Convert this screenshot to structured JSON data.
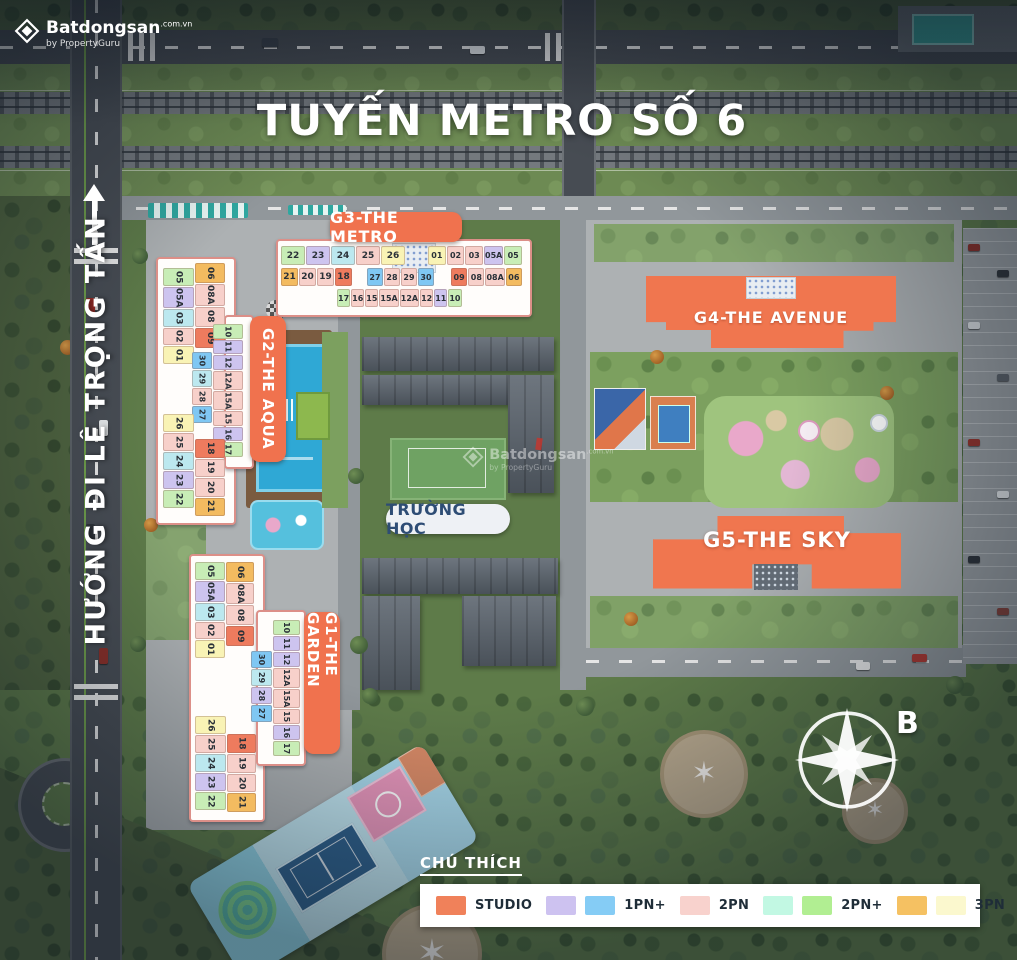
{
  "brand": {
    "name": "Batdongsan",
    "domain": ".com.vn",
    "byline": "by PropertyGuru"
  },
  "title": "TUYẾN METRO SỐ 6",
  "street_label": "HƯỚNG ĐI LÊ TRỌNG TẤN",
  "school_label": "TRƯỜNG HỌC",
  "compass_label": "B",
  "buildings": {
    "g3": {
      "name": "G3-THE METRO",
      "rows": {
        "r1l": [
          {
            "n": "22",
            "c": "#c8edb6"
          },
          {
            "n": "23",
            "c": "#cdc4ef"
          },
          {
            "n": "24",
            "c": "#bce8ef"
          },
          {
            "n": "25",
            "c": "#f7d0ca"
          },
          {
            "n": "26",
            "c": "#f9f3b5"
          }
        ],
        "r1r": [
          {
            "n": "01",
            "c": "#f9f3b5"
          },
          {
            "n": "02",
            "c": "#f7d0ca"
          },
          {
            "n": "03",
            "c": "#f7d0ca"
          },
          {
            "n": "05A",
            "c": "#cdc4ef"
          },
          {
            "n": "05",
            "c": "#c8edb6"
          }
        ],
        "r2l": [
          {
            "n": "21",
            "c": "#f3bb60"
          },
          {
            "n": "20",
            "c": "#f7d0ca"
          },
          {
            "n": "19",
            "c": "#f7d0ca"
          },
          {
            "n": "18",
            "c": "#ee7b5e"
          }
        ],
        "r2m": [
          {
            "n": "27",
            "c": "#7fc7f3"
          },
          {
            "n": "28",
            "c": "#f7d0ca"
          },
          {
            "n": "29",
            "c": "#f7d0ca"
          },
          {
            "n": "30",
            "c": "#7fc7f3"
          }
        ],
        "r2r": [
          {
            "n": "09",
            "c": "#ee7b5e"
          },
          {
            "n": "08",
            "c": "#f7d0ca"
          },
          {
            "n": "08A",
            "c": "#f7d0ca"
          },
          {
            "n": "06",
            "c": "#f3bb60"
          }
        ],
        "r3": [
          {
            "n": "17",
            "c": "#c8edb6"
          },
          {
            "n": "16",
            "c": "#f7d0ca"
          },
          {
            "n": "15",
            "c": "#f7d0ca"
          },
          {
            "n": "15A",
            "c": "#f7d0ca"
          },
          {
            "n": "12A",
            "c": "#f7d0ca"
          },
          {
            "n": "12",
            "c": "#f7d0ca"
          },
          {
            "n": "11",
            "c": "#cdc4ef"
          },
          {
            "n": "10",
            "c": "#c8edb6"
          }
        ]
      }
    },
    "g2": {
      "name": "G2-THE AQUA",
      "cols": {
        "a": [
          {
            "n": "05",
            "c": "#c8edb6"
          },
          {
            "n": "05A",
            "c": "#cdc4ef"
          },
          {
            "n": "03",
            "c": "#bce8ef"
          },
          {
            "n": "02",
            "c": "#f7d0ca"
          },
          {
            "n": "01",
            "c": "#f9f3b5"
          }
        ],
        "b": [
          {
            "n": "06",
            "c": "#f3bb60"
          },
          {
            "n": "08A",
            "c": "#f7d0ca"
          },
          {
            "n": "08",
            "c": "#f7d0ca"
          },
          {
            "n": "09",
            "c": "#ee7b5e"
          }
        ],
        "c": [
          {
            "n": "10",
            "c": "#c8edb6"
          },
          {
            "n": "11",
            "c": "#cdc4ef"
          },
          {
            "n": "12",
            "c": "#cdc4ef"
          },
          {
            "n": "12A",
            "c": "#f7d0ca"
          },
          {
            "n": "15A",
            "c": "#f7d0ca"
          },
          {
            "n": "15",
            "c": "#f7d0ca"
          },
          {
            "n": "16",
            "c": "#cdc4ef"
          },
          {
            "n": "17",
            "c": "#c8edb6"
          }
        ],
        "d": [
          {
            "n": "30",
            "c": "#7fc7f3"
          },
          {
            "n": "29",
            "c": "#bce8ef"
          },
          {
            "n": "28",
            "c": "#f7d0ca"
          },
          {
            "n": "27",
            "c": "#7fc7f3"
          }
        ],
        "e": [
          {
            "n": "26",
            "c": "#f9f3b5"
          },
          {
            "n": "25",
            "c": "#f7d0ca"
          },
          {
            "n": "24",
            "c": "#bce8ef"
          },
          {
            "n": "23",
            "c": "#cdc4ef"
          },
          {
            "n": "22",
            "c": "#c8edb6"
          }
        ],
        "f": [
          {
            "n": "18",
            "c": "#ee7b5e"
          },
          {
            "n": "19",
            "c": "#f7d0ca"
          },
          {
            "n": "20",
            "c": "#f7d0ca"
          },
          {
            "n": "21",
            "c": "#f3bb60"
          }
        ]
      }
    },
    "g1": {
      "name": "G1-THE GARDEN",
      "cols": {
        "a": [
          {
            "n": "05",
            "c": "#c8edb6"
          },
          {
            "n": "05A",
            "c": "#cdc4ef"
          },
          {
            "n": "03",
            "c": "#bce8ef"
          },
          {
            "n": "02",
            "c": "#f7d0ca"
          },
          {
            "n": "01",
            "c": "#f9f3b5"
          }
        ],
        "b": [
          {
            "n": "06",
            "c": "#f3bb60"
          },
          {
            "n": "08A",
            "c": "#f7d0ca"
          },
          {
            "n": "08",
            "c": "#f7d0ca"
          },
          {
            "n": "09",
            "c": "#ee7b5e"
          }
        ],
        "c": [
          {
            "n": "10",
            "c": "#c8edb6"
          },
          {
            "n": "11",
            "c": "#cdc4ef"
          },
          {
            "n": "12",
            "c": "#cdc4ef"
          },
          {
            "n": "12A",
            "c": "#f7d0ca"
          },
          {
            "n": "15A",
            "c": "#f7d0ca"
          },
          {
            "n": "15",
            "c": "#f7d0ca"
          },
          {
            "n": "16",
            "c": "#cdc4ef"
          },
          {
            "n": "17",
            "c": "#c8edb6"
          }
        ],
        "d": [
          {
            "n": "30",
            "c": "#7fc7f3"
          },
          {
            "n": "29",
            "c": "#bce8ef"
          },
          {
            "n": "28",
            "c": "#cdc4ef"
          },
          {
            "n": "27",
            "c": "#7fc7f3"
          }
        ],
        "e": [
          {
            "n": "26",
            "c": "#f9f3b5"
          },
          {
            "n": "25",
            "c": "#f7d0ca"
          },
          {
            "n": "24",
            "c": "#bce8ef"
          },
          {
            "n": "23",
            "c": "#cdc4ef"
          },
          {
            "n": "22",
            "c": "#c8edb6"
          }
        ],
        "f": [
          {
            "n": "18",
            "c": "#ee7b5e"
          },
          {
            "n": "19",
            "c": "#f7d0ca"
          },
          {
            "n": "20",
            "c": "#f7d0ca"
          },
          {
            "n": "21",
            "c": "#f3bb60"
          }
        ]
      }
    },
    "g4": {
      "name": "G4-THE AVENUE"
    },
    "g5": {
      "name": "G5-THE SKY"
    }
  },
  "legend": {
    "title": "CHÚ THÍCH",
    "items": [
      {
        "label": "STUDIO",
        "colors": [
          "#F0815A"
        ]
      },
      {
        "label": "1PN+",
        "colors": [
          "#CDC2F0",
          "#85CCF5"
        ]
      },
      {
        "label": "2PN",
        "colors": [
          "#F8D2CD"
        ]
      },
      {
        "label": "2PN+",
        "colors": [
          "#C2F8E3",
          "#B1EE92"
        ]
      },
      {
        "label": "3PN",
        "colors": [
          "#F5C162",
          "#FBF8CE"
        ]
      }
    ]
  }
}
